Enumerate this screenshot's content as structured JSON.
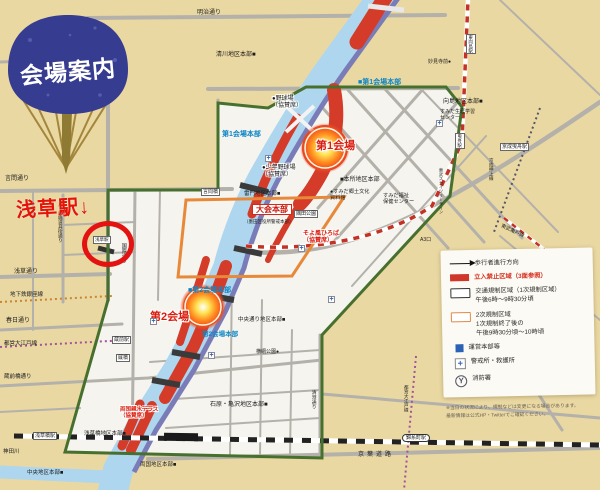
{
  "fan": {
    "label": "会場案内"
  },
  "annotation": {
    "text": "浅草駅↓"
  },
  "colors": {
    "paper": "#ead8a2",
    "regulated_fill": "#f5f4ee",
    "river": "#aed6ee",
    "expressway": "#7a7cb8",
    "no_entry_red": "#d43b28",
    "green_boundary": "#47702e",
    "orange_boundary": "#e8893a",
    "hq_blue": "#0d86c6",
    "annotation_red": "#e41210",
    "fan_blue": "#363c8f"
  },
  "legend": {
    "items": [
      {
        "icon": "arrow",
        "label": "歩行者進行方向",
        "red": false
      },
      {
        "icon": "redbar",
        "label": "立入禁止区域（3面参照）",
        "red": true
      },
      {
        "icon": "box",
        "label": "交通規制区域（1次規制区域）\n午後6時〜9時30分頃",
        "red": false
      },
      {
        "icon": "obox",
        "label": "2次規制区域\n1次規制終了後の\n午後9時30分頃〜10時頃",
        "red": false
      },
      {
        "icon": "bluesq",
        "label": "運営本部等",
        "red": false
      },
      {
        "icon": "plus",
        "label": "警戒所・救護所",
        "red": false
      },
      {
        "icon": "fire",
        "label": "消防署",
        "red": false
      }
    ]
  },
  "footnote": {
    "line1": "※当日の状況により、規制などは変更になる場合があります。",
    "line2": "最新情報は公式HP・Twitterでご確認ください。"
  },
  "map": {
    "labels": [
      {
        "t": "明治通り",
        "x": 197,
        "y": 10,
        "s": 6
      },
      {
        "t": "言問通り",
        "x": 5,
        "y": 176,
        "s": 6
      },
      {
        "t": "浅草通り",
        "x": 14,
        "y": 269,
        "s": 6
      },
      {
        "t": "地下鉄銀座線",
        "x": 10,
        "y": 292,
        "s": 5.5
      },
      {
        "t": "春日通り",
        "x": 6,
        "y": 318,
        "s": 6
      },
      {
        "t": "都営大江戸線",
        "x": 4,
        "y": 341,
        "s": 5.5
      },
      {
        "t": "蔵前橋通り",
        "x": 4,
        "y": 374,
        "s": 5.5
      },
      {
        "t": "神田川",
        "x": 3,
        "y": 449,
        "s": 5.5
      },
      {
        "t": "かっぱ橋道具街通り",
        "x": 58,
        "y": 202,
        "s": 4.5,
        "v": true
      },
      {
        "t": "国際通り",
        "x": 120,
        "y": 243,
        "s": 5,
        "v": true
      },
      {
        "t": "清川地区本部■",
        "x": 216,
        "y": 52,
        "s": 6
      },
      {
        "t": "妙見寺前●",
        "x": 428,
        "y": 60,
        "s": 5
      },
      {
        "t": "■第1会場本部",
        "x": 358,
        "y": 79,
        "s": 7,
        "c": "blue"
      },
      {
        "t": "東向島駅",
        "x": 466,
        "y": 34,
        "s": 4.5,
        "v": true,
        "b": true
      },
      {
        "t": "向島地区本部■",
        "x": 443,
        "y": 99,
        "s": 6
      },
      {
        "t": "すみだ生涯学習\nセンター",
        "x": 440,
        "y": 110,
        "s": 5
      },
      {
        "t": "曳舟駅",
        "x": 455,
        "y": 133,
        "s": 4.5,
        "v": true,
        "b": true
      },
      {
        "t": "京成曳舟駅",
        "x": 500,
        "y": 143,
        "s": 5,
        "b": true
      },
      {
        "t": "京成押上線",
        "x": 489,
        "y": 158,
        "s": 4.5,
        "v": true
      },
      {
        "t": "東武スカイツリーライン",
        "x": 438,
        "y": 168,
        "s": 4.2,
        "v": true
      },
      {
        "t": "東武亀戸線",
        "x": 502,
        "y": 224,
        "s": 5,
        "rot": 25
      },
      {
        "t": "●野球場\n（協賛席）",
        "x": 272,
        "y": 96,
        "s": 6,
        "h": true
      },
      {
        "t": "第1会場",
        "x": 316,
        "y": 140,
        "s": 11,
        "c": "red",
        "h": true
      },
      {
        "t": "●少年野球場\n（協賛席）",
        "x": 262,
        "y": 165,
        "s": 6,
        "h": true
      },
      {
        "t": "第1会場本部",
        "x": 222,
        "y": 131,
        "s": 7,
        "c": "blue"
      },
      {
        "t": "■本所地区本部",
        "x": 340,
        "y": 177,
        "s": 6
      },
      {
        "t": "●すみだ郷土文化\n資料館",
        "x": 330,
        "y": 189,
        "s": 5.2
      },
      {
        "t": "すみだ福祉\n保健センター",
        "x": 383,
        "y": 193,
        "s": 5.2
      },
      {
        "t": "言問橋",
        "x": 201,
        "y": 188,
        "s": 5,
        "b": true
      },
      {
        "t": "雷門地区本部■",
        "x": 244,
        "y": 191,
        "s": 5.5
      },
      {
        "t": "大会本部",
        "x": 252,
        "y": 204,
        "s": 8,
        "rb": true
      },
      {
        "t": "（墨田区役所警戒本部）",
        "x": 244,
        "y": 219,
        "s": 4.5
      },
      {
        "t": "隅田公園",
        "x": 294,
        "y": 210,
        "s": 5,
        "b": true
      },
      {
        "t": "そよ風ひろば\n（協賛席）",
        "x": 303,
        "y": 231,
        "s": 6,
        "c": "red",
        "h": true
      },
      {
        "t": "A3口",
        "x": 420,
        "y": 238,
        "s": 5
      },
      {
        "t": "浅草駅",
        "x": 93,
        "y": 236,
        "s": 4.5,
        "b": true
      },
      {
        "t": "■第2会場本部",
        "x": 188,
        "y": 287,
        "s": 7,
        "c": "blue"
      },
      {
        "t": "第2会場",
        "x": 150,
        "y": 311,
        "s": 11,
        "c": "red",
        "h": true
      },
      {
        "t": "第2会場本部",
        "x": 202,
        "y": 331,
        "s": 6.5,
        "c": "blue"
      },
      {
        "t": "中央通り地区本部■",
        "x": 238,
        "y": 317,
        "s": 5.5
      },
      {
        "t": "蔵前駅",
        "x": 112,
        "y": 336,
        "s": 5,
        "b": true
      },
      {
        "t": "厩橋",
        "x": 116,
        "y": 354,
        "s": 5,
        "b": true
      },
      {
        "t": "横網公園●",
        "x": 256,
        "y": 350,
        "s": 5
      },
      {
        "t": "清澄通り",
        "x": 310,
        "y": 390,
        "s": 4.8,
        "v": true
      },
      {
        "t": "都営大江戸線",
        "x": 404,
        "y": 385,
        "s": 4.5,
        "v": true
      },
      {
        "t": "石原・亀沢地区本部■",
        "x": 210,
        "y": 402,
        "s": 6
      },
      {
        "t": "両国親水テラス\n（協賛席）",
        "x": 120,
        "y": 407,
        "s": 5.5,
        "c": "red",
        "h": true
      },
      {
        "t": "浅草橋駅",
        "x": 33,
        "y": 432,
        "s": 5,
        "b": true
      },
      {
        "t": "浅草橋地区本部■",
        "x": 84,
        "y": 431,
        "s": 5.5
      },
      {
        "t": "両国地区本部■",
        "x": 140,
        "y": 462,
        "s": 5.5
      },
      {
        "t": "中央地区本部■",
        "x": 27,
        "y": 470,
        "s": 5.5
      },
      {
        "t": "錦糸町駅",
        "x": 402,
        "y": 434,
        "s": 5,
        "b": true,
        "ov": true
      },
      {
        "t": "京葉道路",
        "x": 358,
        "y": 452,
        "s": 6,
        "ls": 3
      }
    ],
    "aid_markers": [
      {
        "x": 265,
        "y": 155
      },
      {
        "x": 298,
        "y": 245
      },
      {
        "x": 208,
        "y": 352
      },
      {
        "x": 328,
        "y": 296
      },
      {
        "x": 150,
        "y": 318
      },
      {
        "x": 436,
        "y": 120
      }
    ]
  }
}
